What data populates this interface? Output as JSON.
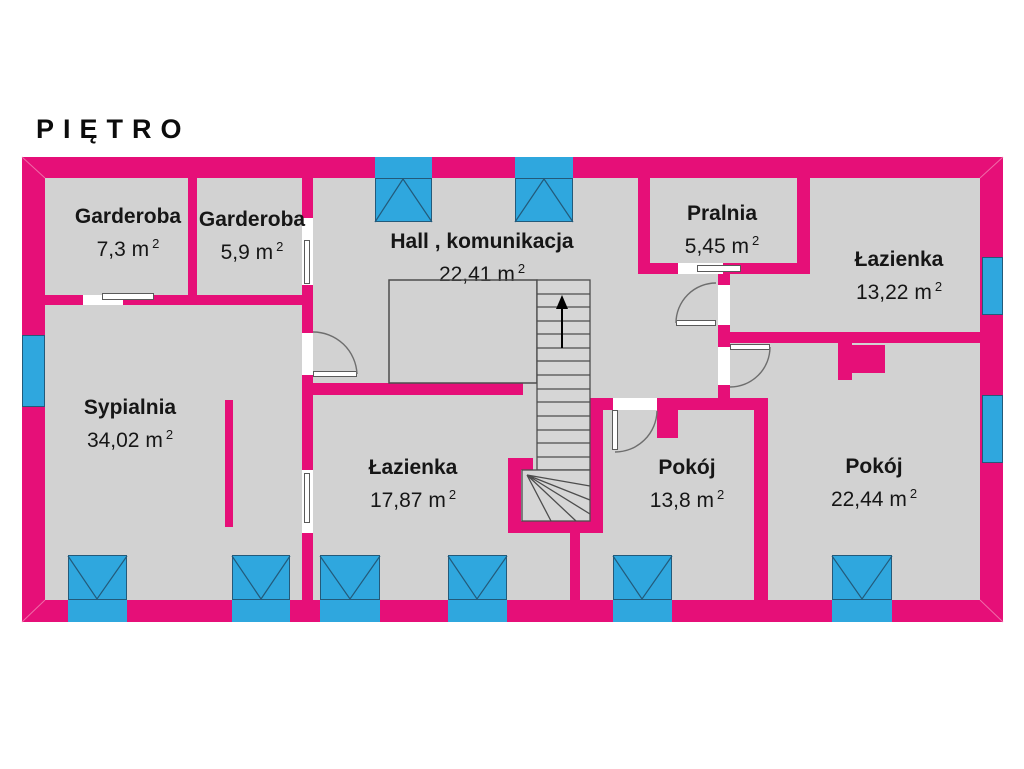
{
  "title": "PIĘTRO",
  "colors": {
    "wall_pink": "#e60f78",
    "window_blue": "#2fa7de",
    "floor_gray": "#d2d2d2",
    "background": "#ffffff",
    "text": "#161616"
  },
  "rooms": [
    {
      "id": "garderoba-1",
      "name": "Garderoba",
      "area": "7,3 m",
      "sup": "2"
    },
    {
      "id": "garderoba-2",
      "name": "Garderoba",
      "area": "5,9 m",
      "sup": "2"
    },
    {
      "id": "hall",
      "name": "Hall , komunikacja",
      "area": "22,41 m",
      "sup": "2"
    },
    {
      "id": "pralnia",
      "name": "Pralnia",
      "area": "5,45 m",
      "sup": "2"
    },
    {
      "id": "lazienka-gorna",
      "name": "Łazienka",
      "area": "13,22 m",
      "sup": "2"
    },
    {
      "id": "sypialnia",
      "name": "Sypialnia",
      "area": "34,02 m",
      "sup": "2"
    },
    {
      "id": "lazienka-dolna",
      "name": "Łazienka",
      "area": "17,87 m",
      "sup": "2"
    },
    {
      "id": "pokoj-1",
      "name": "Pokój",
      "area": "13,8 m",
      "sup": "2"
    },
    {
      "id": "pokoj-2",
      "name": "Pokój",
      "area": "22,44 m",
      "sup": "2"
    }
  ]
}
